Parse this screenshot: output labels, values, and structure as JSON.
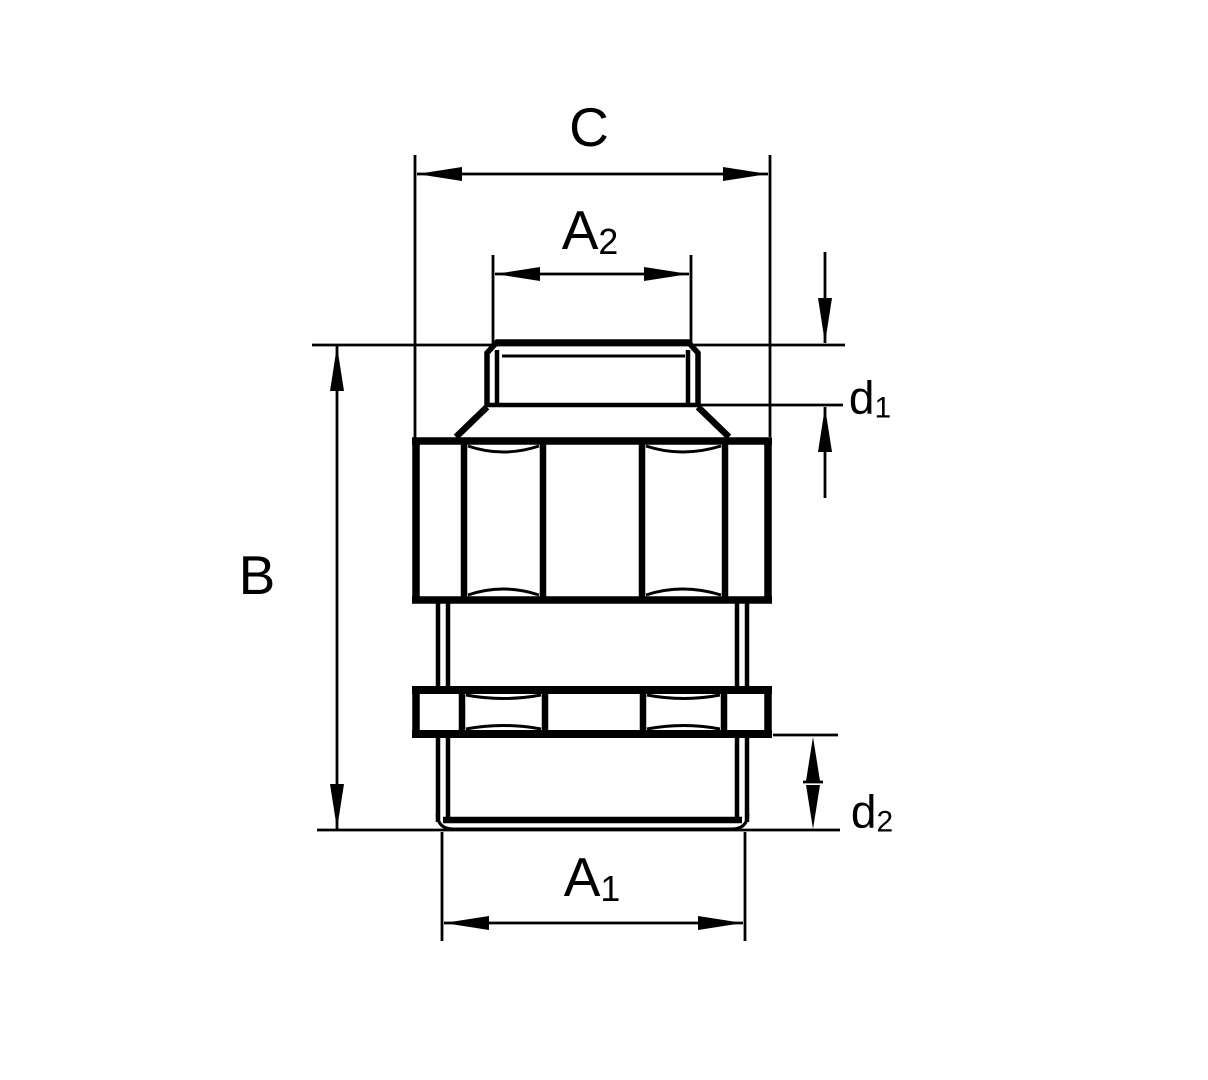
{
  "drawing": {
    "kind": "technical-dimension-drawing",
    "view": "front elevation of threaded fitting with hex nut and locknut"
  },
  "colors": {
    "line": "#000000",
    "background": "#ffffff"
  },
  "labels": {
    "c": {
      "main": "C",
      "sub": ""
    },
    "a2": {
      "main": "A",
      "sub": "2"
    },
    "b": {
      "main": "B",
      "sub": ""
    },
    "d1": {
      "main": "d",
      "sub": "1"
    },
    "d2": {
      "main": "d",
      "sub": "2"
    },
    "a1": {
      "main": "A",
      "sub": "1"
    }
  }
}
